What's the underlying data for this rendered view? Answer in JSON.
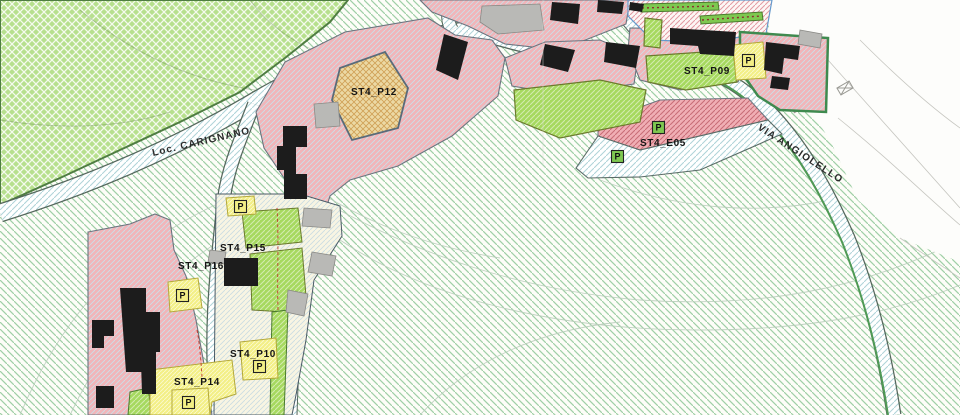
{
  "map": {
    "street_labels": [
      {
        "id": "loc-carignano",
        "text": "Loc. CARIGNANO"
      },
      {
        "id": "via-angiolello",
        "text": "VIA ANGIOLELLO"
      }
    ],
    "zone_labels": [
      {
        "id": "st4-p12",
        "text": "ST4_P12"
      },
      {
        "id": "st4-p09",
        "text": "ST4_P09"
      },
      {
        "id": "st4-e05",
        "text": "ST4_E05"
      },
      {
        "id": "st4-p15",
        "text": "ST4_P15"
      },
      {
        "id": "st4-p16",
        "text": "ST4_P16"
      },
      {
        "id": "st4-p10",
        "text": "ST4_P10"
      },
      {
        "id": "st4-p14",
        "text": "ST4_P14"
      }
    ],
    "parking_symbol": "P",
    "colors": {
      "residential_pink": "#f1b5b9",
      "residential_hatch": "#ccdfe6",
      "pink_red_hatch": "#c76b75",
      "green_area": "#b7e08e",
      "agricultural_line": "#9fcfa6",
      "bright_green": "#a6d95f",
      "parking_yellow": "#f3ef86",
      "zone_tan": "#ecd9a4",
      "tan_cross": "#cfa055",
      "building_black": "#1c1c1c",
      "building_gray": "#b9b9b6",
      "road_hatch_blue": "#aed3d8",
      "border_green": "#3f8a4f",
      "orchard_red_hatch": "#e29aa2",
      "label_black": "#151515"
    }
  }
}
